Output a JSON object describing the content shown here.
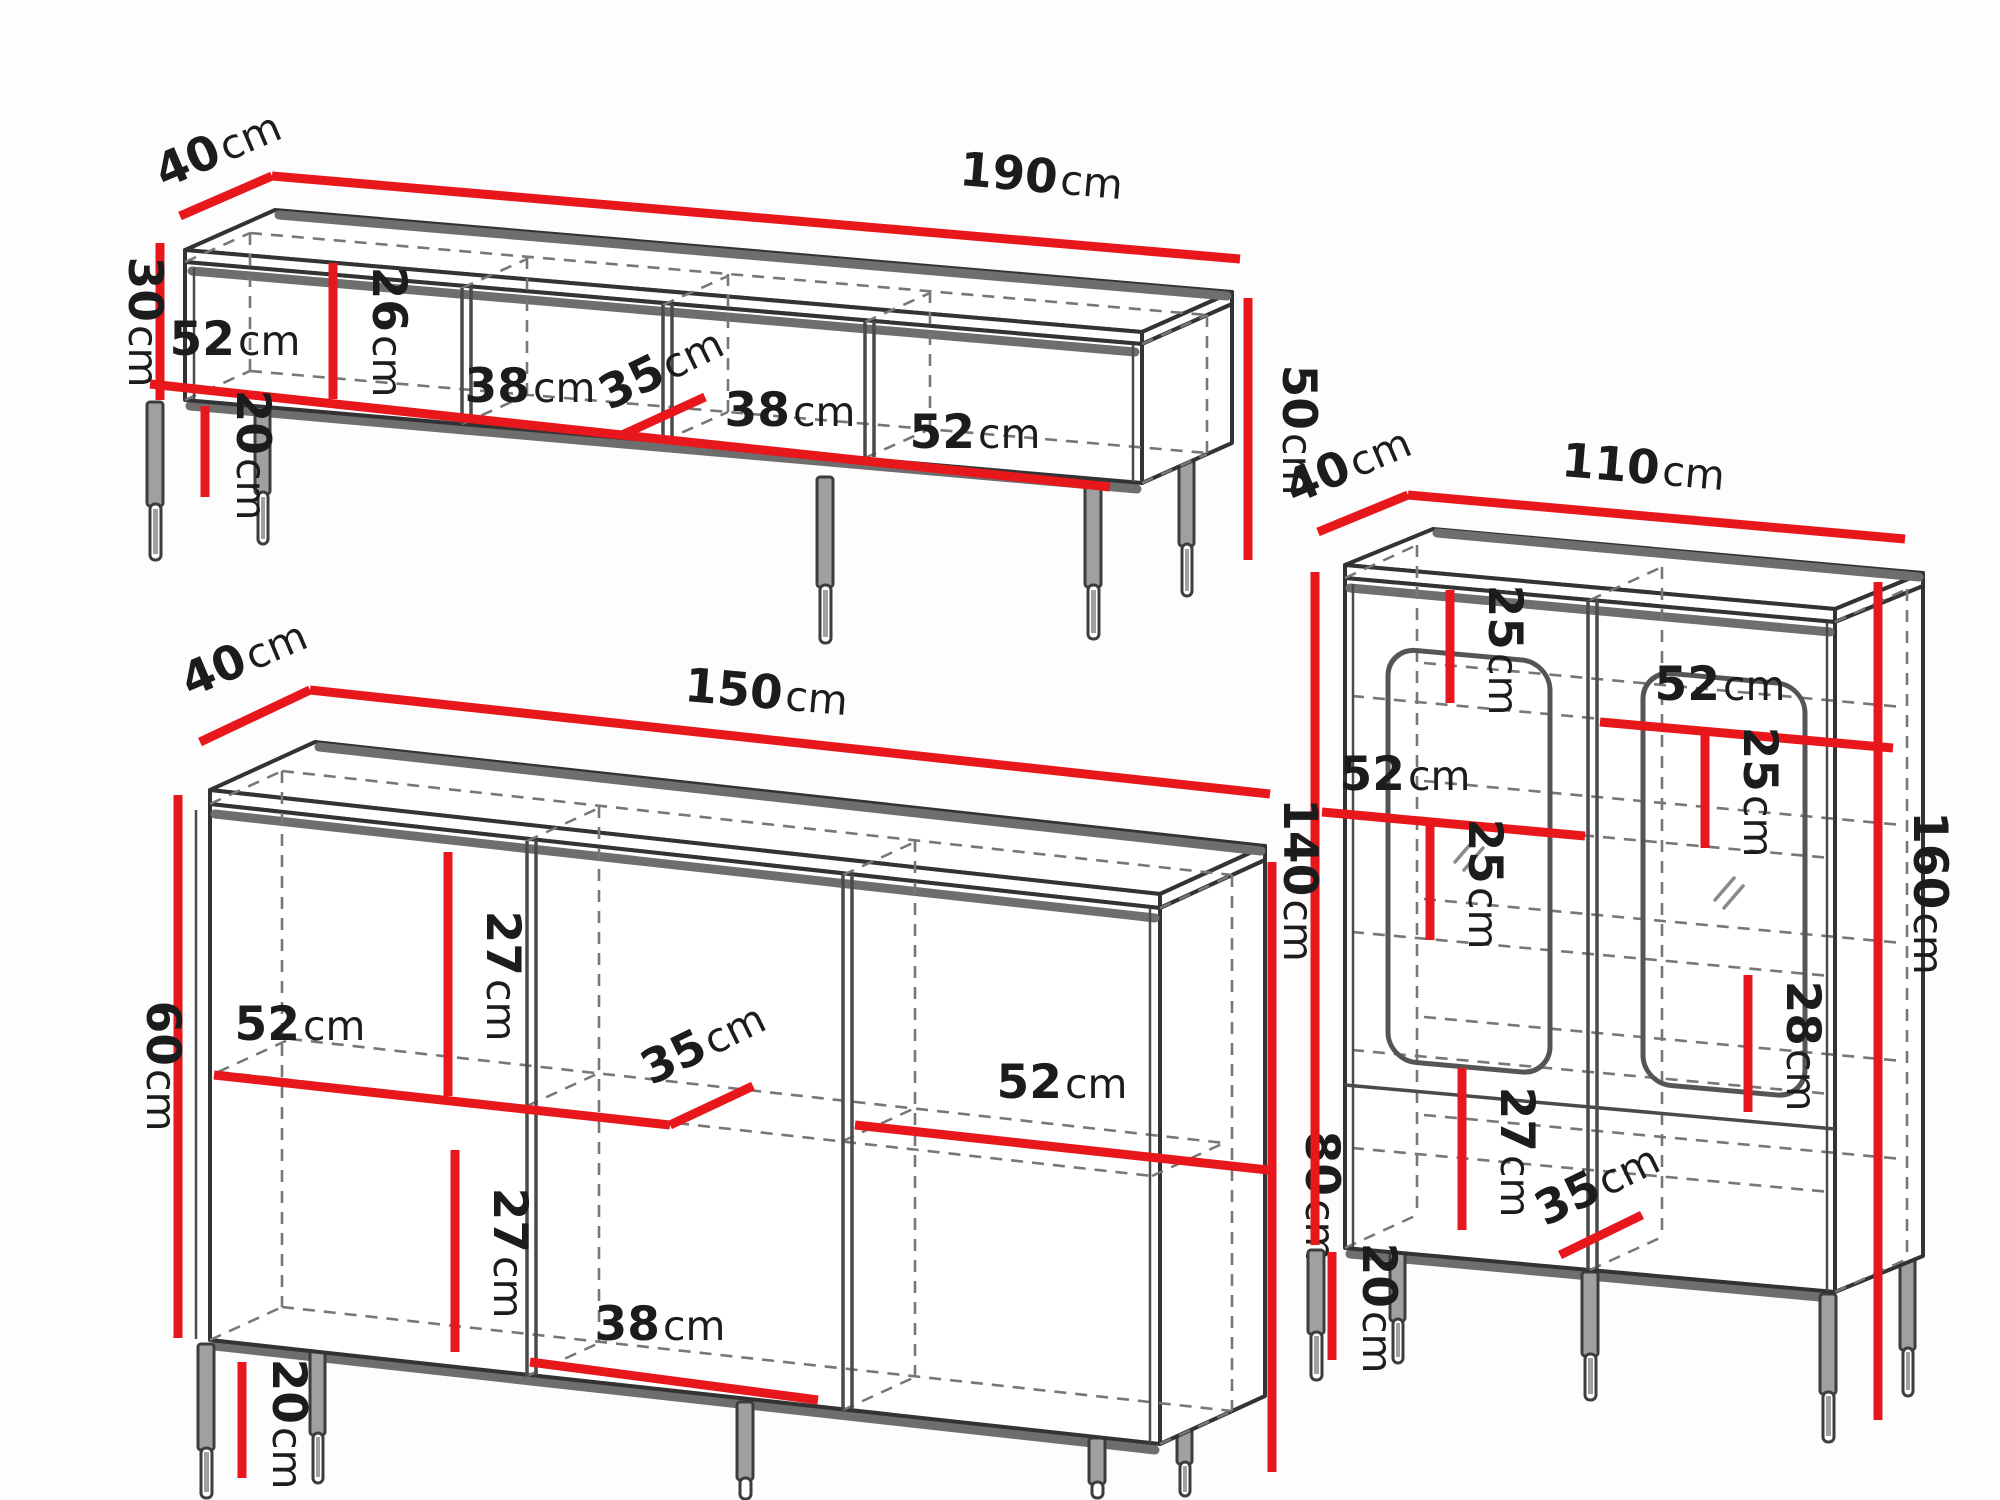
{
  "unit": "cm",
  "colors": {
    "dimension_red": "#e8171c",
    "outline_dark": "#333333",
    "shadow_gray": "#6e6e6e",
    "dashed_gray": "#777777",
    "leg_gray": "#a0a0a0",
    "background": "#fdfdfd",
    "text": "#1c1c1c"
  },
  "tv_stand": {
    "width": "190",
    "depth": "40",
    "body_height": "30",
    "total_height": "50",
    "inner_height": "26",
    "bay1_width": "52",
    "bay2_width": "38",
    "inner_depth": "35",
    "bay3_width": "38",
    "bay4_width": "52",
    "leg_height": "20"
  },
  "sideboard": {
    "width": "150",
    "depth": "40",
    "body_height": "60",
    "total_height": "80",
    "upper_inner_height": "27",
    "upper_shelf_width": "52",
    "inner_depth": "35",
    "lower_inner_height": "27",
    "lower_shelf_width": "52",
    "bottom_bay_width": "38",
    "leg_height": "20"
  },
  "display_cabinet": {
    "width": "110",
    "depth": "40",
    "body_height": "140",
    "total_height": "160",
    "top_section_height": "25",
    "right_shelf_width": "52",
    "right_section_height": "25",
    "left_shelf_width": "52",
    "left_section_height": "25",
    "lower_right_height": "28",
    "lower_left_height": "27",
    "inner_depth": "35",
    "leg_height": "20"
  }
}
